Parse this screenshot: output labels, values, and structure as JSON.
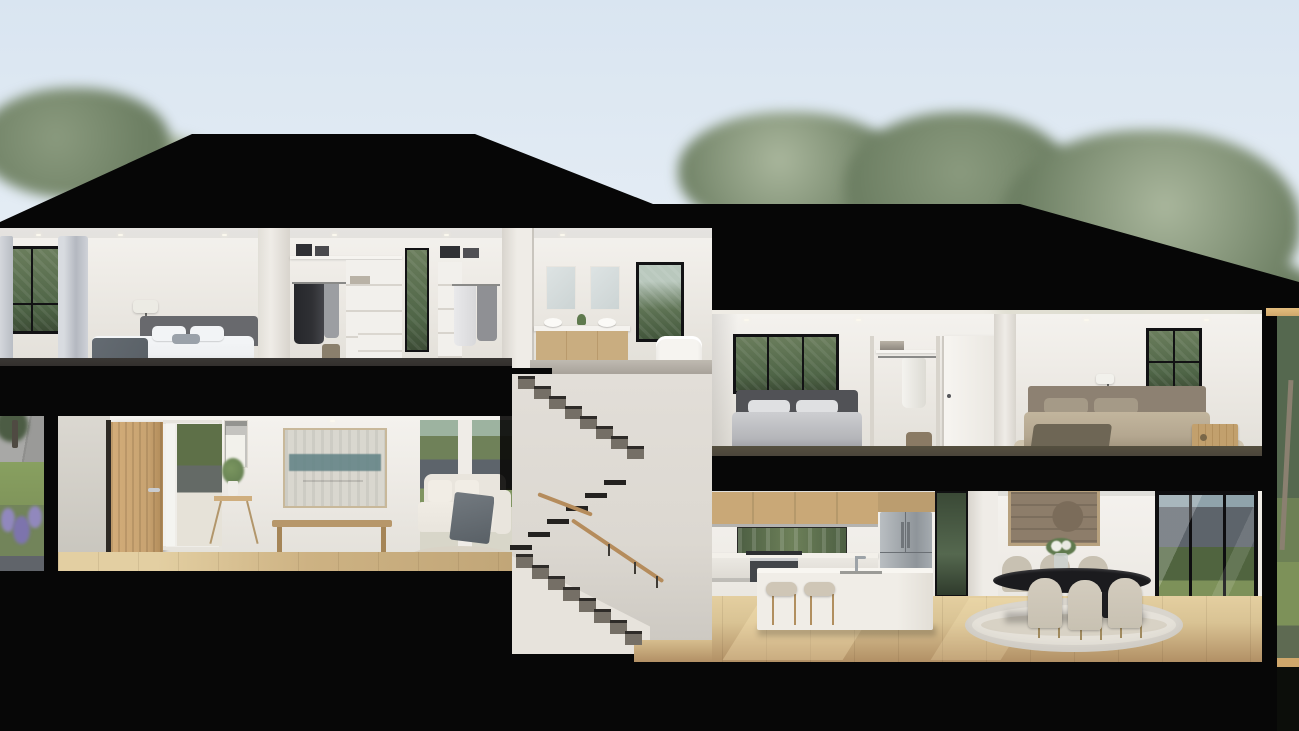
{
  "scene": {
    "label": "two-storey-split-level-house-cross-section-render",
    "levels": {
      "upper": [
        "master-bedroom",
        "walk-in-robe",
        "walk-in-robe-2",
        "ensuite-bathroom",
        "bedroom-2",
        "robe-hallway",
        "bedroom-3"
      ],
      "lower": [
        "entry",
        "hallway",
        "living-room",
        "switchback-staircase",
        "kitchen",
        "dining-room"
      ]
    },
    "exterior": [
      "street",
      "front-garden",
      "lavender-bed",
      "trees",
      "black-hip-roof",
      "backyard-fence",
      "patio",
      "lawn"
    ]
  },
  "colors": {
    "sky_top": "#d9e5f1",
    "sky_bot": "#eef3f7",
    "tree_a": "#6d7f63",
    "tree_b": "#8a9a7e",
    "tree_c": "#a9b69c",
    "black": "#070707",
    "roof": "#060606",
    "wall": "#efece7",
    "wall2": "#e2dfd8",
    "wall3": "#cfccc5",
    "ceil": "#f4f2ee",
    "carpet": "#2b2927",
    "carpet2": "#4a443b",
    "floor_a": "#d9c394",
    "floor_b": "#b29065",
    "frame": "#121214",
    "hedge": "#4f6547",
    "glassgr": "#3a4936",
    "curtain": "#c6c9ce",
    "shade": "#ecebe4",
    "head_gray": "#68696d",
    "duvet": "#eef0f2",
    "throw": "#596066",
    "pillow": "#f2f4f6",
    "robe": "#f2f0ec",
    "cloth_d": "#2f3034",
    "cloth_l": "#d8d8da",
    "door_oak": "#c8a371",
    "cab_oak": "#c9a877",
    "vanity_oak": "#c9ad80",
    "mirror": "#ccd4d4",
    "tub": "#f6f4f0",
    "steel": "#9da3a8",
    "island": "#f0ede7",
    "stool": "#cfc6b6",
    "table": "#1b1b1e",
    "chair": "#c8c1b2",
    "rug": "#d8d2c5",
    "art_teal": "#5f8184",
    "art_canvas": "#d9d7cf",
    "art2": "#8d7d6a",
    "art2f": "#b7a17e",
    "bench": "#b7976a",
    "sofa": "#e9e5dd",
    "grass": "#7d9159",
    "lav": "#9188bd",
    "road": "#a2a2a0",
    "fence": "#5d646b",
    "paving": "#c4c7c8",
    "rail": "#b58c5c",
    "tread": "#756f66",
    "stringer": "#e7e3dc",
    "stairwall": "#dcd8d1",
    "gold": "#cfa76b",
    "bag": "#8a7a64",
    "plant": "#5f7a4e",
    "b3head": "#8d8172",
    "b3duvet": "#b4a790",
    "b3throw": "#6e6655",
    "sidetab": "#c2a06d"
  }
}
